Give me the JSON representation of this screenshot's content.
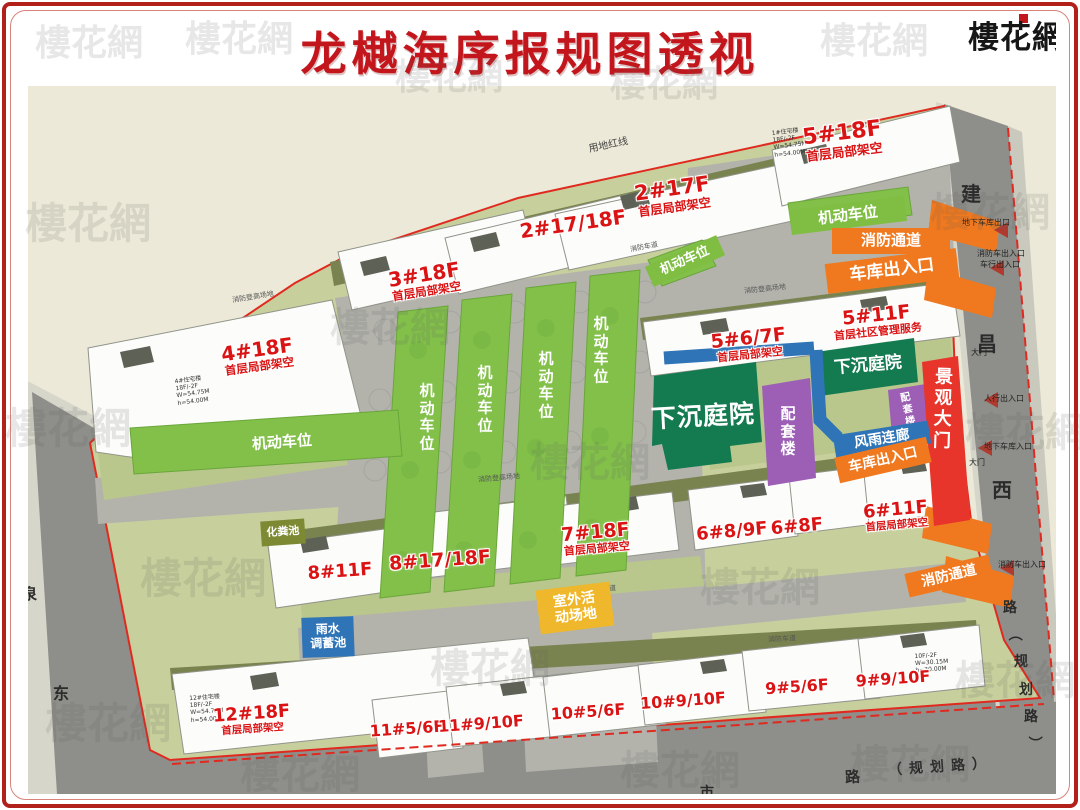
{
  "header": {
    "title": "龙樾海序报规图透视",
    "logo": "樓花網"
  },
  "watermark_text": "樓花網",
  "site": {
    "red_line_label": "用地红线"
  },
  "roads": {
    "east_chars": [
      "建",
      "昌",
      "西",
      "路",
      "（",
      "规",
      "划",
      "路",
      "）"
    ],
    "west_chars": [
      "泉",
      "东"
    ],
    "south_road": "路",
    "south_planned": "（规划路）",
    "south_partial": "市"
  },
  "buildings": [
    {
      "label": "5#18F",
      "sub": "首层局部架空"
    },
    {
      "label": "2#17F",
      "sub": "首层局部架空"
    },
    {
      "label": "2#17/18F",
      "sub": ""
    },
    {
      "label": "3#18F",
      "sub": "首层局部架空"
    },
    {
      "label": "4#18F",
      "sub": "首层局部架空"
    },
    {
      "label": "5#6/7F",
      "sub": "首层局部架空"
    },
    {
      "label": "5#11F",
      "sub": "首层社区管理服务"
    },
    {
      "label": "7#18F",
      "sub": "首层局部架空"
    },
    {
      "label": "8#17/18F",
      "sub": ""
    },
    {
      "label": "8#11F",
      "sub": ""
    },
    {
      "label": "6#8/9F",
      "sub": ""
    },
    {
      "label": "6#8F",
      "sub": ""
    },
    {
      "label": "6#11F",
      "sub": "首层局部架空"
    },
    {
      "label": "12#18F",
      "sub": "首层局部架空"
    },
    {
      "label": "11#5/6F",
      "sub": ""
    },
    {
      "label": "11#9/10F",
      "sub": ""
    },
    {
      "label": "10#5/6F",
      "sub": ""
    },
    {
      "label": "10#9/10F",
      "sub": ""
    },
    {
      "label": "9#5/6F",
      "sub": ""
    },
    {
      "label": "9#9/10F",
      "sub": ""
    }
  ],
  "zones": {
    "parking": "机动车位",
    "fire_lane": "消防通道",
    "garage_entrance": "车库出入口",
    "sunken_courtyard": "下沉庭院",
    "support_building": "配套楼",
    "landscape_gate": "景观大门",
    "covered_corridor": "风雨连廊",
    "outdoor_activity_l1": "室外活",
    "outdoor_activity_l2": "动场地",
    "rain_tank_l1": "雨水",
    "rain_tank_l2": "调蓄池",
    "septic_tank": "化粪池"
  },
  "marks": {
    "underground_garage_exit": "地下车库出口",
    "fire_truck_entrance": "消防车出入口",
    "vehicle_entrance": "车行出入口",
    "gate": "大门",
    "pedestrian_entrance": "人行出入口",
    "underground_garage_in": "地下车库入口",
    "fire_truck_exit": "消防车出入口",
    "fire_lane_road": "消防车道",
    "fire_climb_area": "消防登高场地"
  },
  "notes": [
    {
      "text": "1#住宅楼\n18F/-2F\nW=54.75M\nh=54.00M"
    },
    {
      "text": "4#住宅楼\n18F/-2F\nW=54.75M\nh=54.00M"
    },
    {
      "text": "12#住宅楼\n18F/-2F\nW=54.75M\nh=54.00M"
    },
    {
      "text": "10F/-2F\nW=30.15M\nh=30.00M"
    }
  ],
  "colors": {
    "title_red": "#C3161C",
    "building_label_red": "#DA1414",
    "parking_green": "#7FBE42",
    "fire_orange": "#F0791F",
    "courtyard_green": "#147A50",
    "support_purple": "#9C5FB5",
    "gate_red": "#E7352B",
    "corridor_blue": "#2E74B6",
    "activity_yellow": "#EFB72B",
    "septic_olive": "#7D8A33",
    "boundary_red": "#E02A20"
  }
}
